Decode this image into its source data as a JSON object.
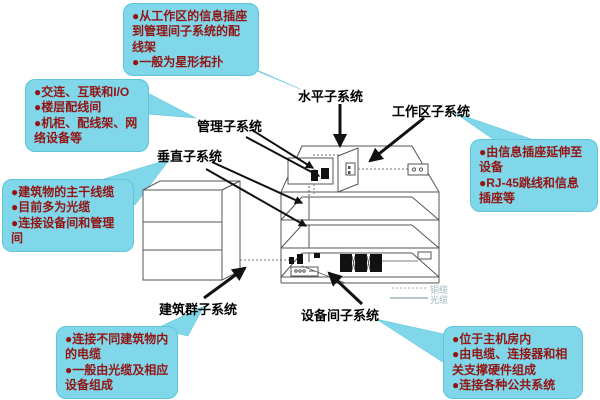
{
  "diagram": {
    "title_implicit": "综合布线系统子系统示意图",
    "callouts": {
      "horizontal_note": {
        "lines": [
          "●从工作区的信息插座到管理间子系统的配线架",
          "●一般为星形拓扑"
        ]
      },
      "management_note": {
        "lines": [
          "●交连、互联和I/O",
          "●楼层配线间",
          "●机柜、配线架、网络设备等"
        ]
      },
      "backbone_note": {
        "lines": [
          "●建筑物的主干线缆",
          "●目前多为光缆",
          "●连接设备间和管理间"
        ]
      },
      "campus_note": {
        "lines": [
          "●连接不同建筑物内的电缆",
          "●一般由光缆及相应设备组成"
        ]
      },
      "workarea_note": {
        "lines": [
          "●由信息插座延伸至设备",
          "●RJ-45跳线和信息插座等"
        ]
      },
      "equipment_note": {
        "lines": [
          "●位于主机房内",
          "●由电缆、连接器和相关支撑硬件组成",
          "●连接各种公共系统"
        ]
      }
    },
    "labels": {
      "horizontal": "水平子系统",
      "workarea": "工作区子系统",
      "management": "管理子系统",
      "vertical": "垂直子系统",
      "campus": "建筑群子系统",
      "equipment_room": "设备间子系统"
    },
    "legend": {
      "copper": "铜缆",
      "fiber": "光缆"
    },
    "colors": {
      "callout_bg": "#7fd7e9",
      "callout_text": "#941414",
      "label_text": "#000000",
      "legend_text": "#9fb6bd",
      "building_line": "#555555",
      "arrow": "#111111"
    }
  }
}
